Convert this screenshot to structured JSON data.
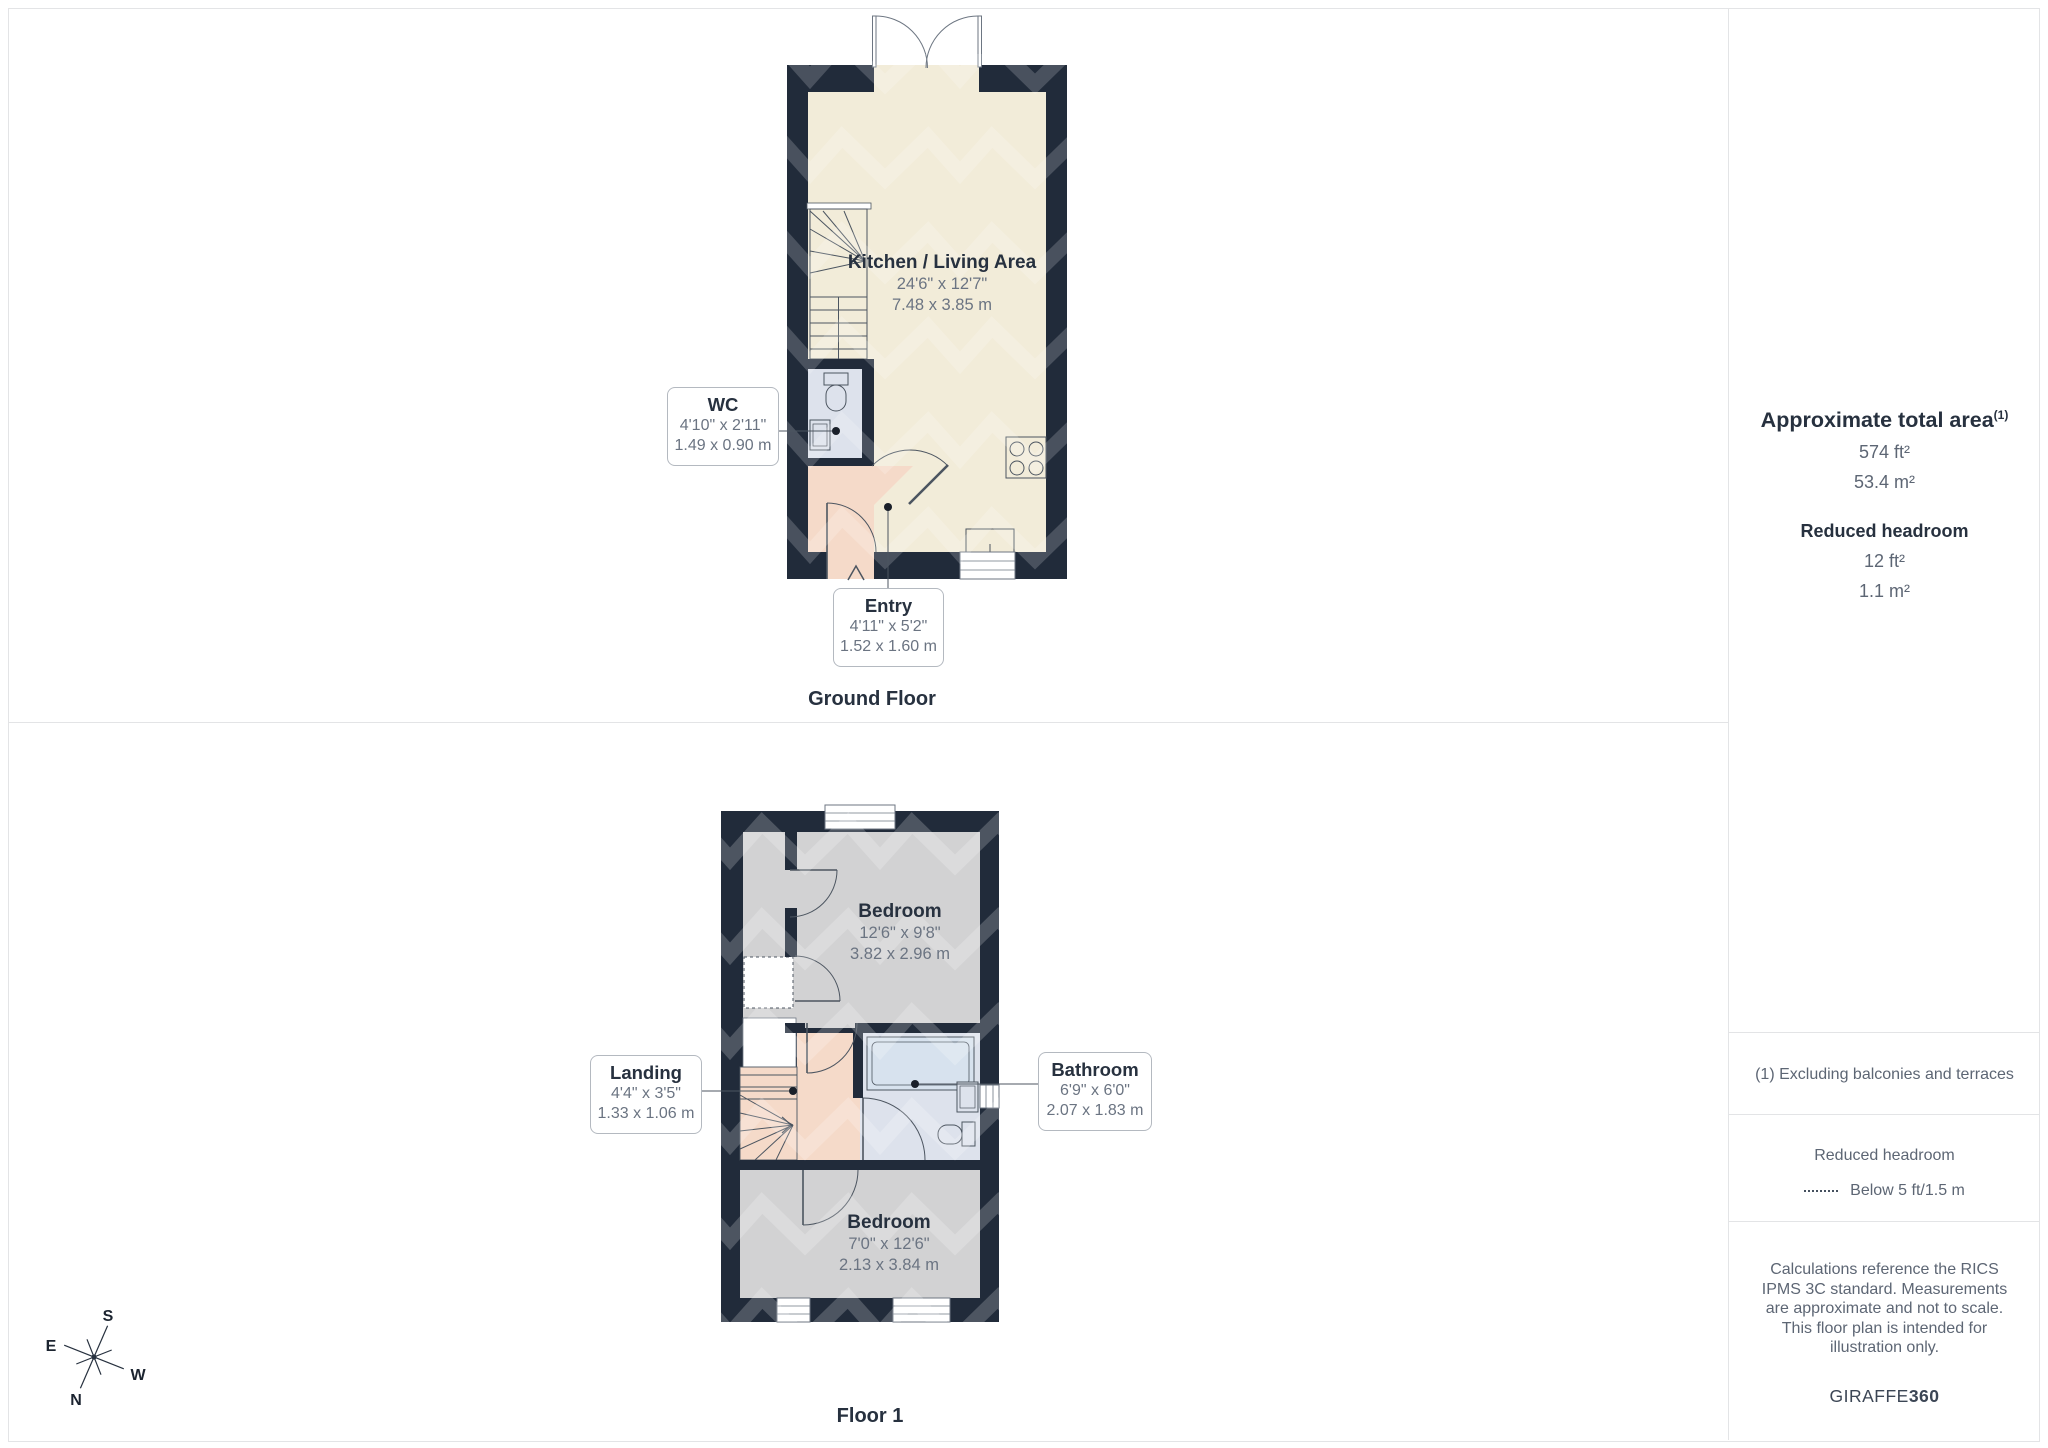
{
  "ground_floor": {
    "title": "Ground Floor",
    "kitchen": {
      "name": "Kitchen / Living Area",
      "imperial": "24'6\" x 12'7\"",
      "metric": "7.48 x 3.85 m"
    },
    "wc": {
      "name": "WC",
      "imperial": "4'10\" x 2'11\"",
      "metric": "1.49 x 0.90 m"
    },
    "entry": {
      "name": "Entry",
      "imperial": "4'11\" x 5'2\"",
      "metric": "1.52 x 1.60 m"
    }
  },
  "floor_1": {
    "title": "Floor 1",
    "bedroom_top": {
      "name": "Bedroom",
      "imperial": "12'6\" x 9'8\"",
      "metric": "3.82 x 2.96 m"
    },
    "landing": {
      "name": "Landing",
      "imperial": "4'4\" x 3'5\"",
      "metric": "1.33 x 1.06 m"
    },
    "bathroom": {
      "name": "Bathroom",
      "imperial": "6'9\" x 6'0\"",
      "metric": "2.07 x 1.83 m"
    },
    "bedroom_bottom": {
      "name": "Bedroom",
      "imperial": "7'0\" x 12'6\"",
      "metric": "2.13 x 3.84 m"
    }
  },
  "sidebar": {
    "total_area_title": "Approximate total area",
    "total_area_footnote": "(1)",
    "total_area_ft": "574 ft²",
    "total_area_m": "53.4 m²",
    "reduced_headroom_title": "Reduced headroom",
    "reduced_headroom_ft": "12 ft²",
    "reduced_headroom_m": "1.1 m²",
    "footnote": "(1) Excluding balconies and terraces",
    "legend_title": "Reduced headroom",
    "legend_item": "Below 5 ft/1.5 m",
    "disclaimer": "Calculations reference the RICS IPMS 3C standard. Measurements are approximate and not to scale. This floor plan is intended for illustration only.",
    "brand_regular": "GIRAFFE",
    "brand_bold": "360"
  },
  "compass": {
    "north": "N",
    "south": "S",
    "east": "E",
    "west": "W"
  },
  "colors": {
    "wall": "#212b3a",
    "kitchen_floor": "#f2ecd9",
    "wet_floor": "#dde2ec",
    "entry_floor": "#f5dac9",
    "bedroom_floor": "#d2d2d3",
    "accent_text": "#27313f",
    "muted_text": "#5d6674"
  }
}
